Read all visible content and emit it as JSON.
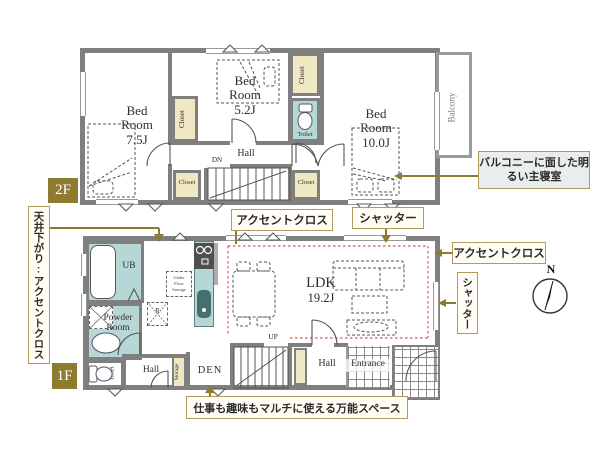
{
  "colors": {
    "wall": "#7f7f7f",
    "closet_fill": "#efe8c2",
    "water_fill": "#b7d6d6",
    "floor_badge": "#8d7b30",
    "annotation_border": "#b3995c",
    "leader_line": "#8d7b30",
    "accent_dotted": "#e07070"
  },
  "floor2": {
    "badge": "2F",
    "bedroom_75": {
      "l1": "Bed",
      "l2": "Room",
      "l3": "7.5J"
    },
    "bedroom_52": {
      "l1": "Bed",
      "l2": "Room",
      "l3": "5.2J"
    },
    "bedroom_100": {
      "l1": "Bed",
      "l2": "Room",
      "l3": "10.0J"
    },
    "hall": "Hall",
    "dn": "DN",
    "closet_left": "Closet",
    "closet_top": "Closet",
    "closet_stair_left": "Closet",
    "closet_stair_right": "Closet",
    "toilet": "Toilet",
    "balcony": "Balcony"
  },
  "floor1": {
    "badge": "1F",
    "ub": "UB",
    "powder": {
      "l1": "Powder",
      "l2": "Room"
    },
    "toilet": "Toilet",
    "hall_left": "Hall",
    "storage": "Storage",
    "den": "DEN",
    "up": "UP",
    "ldk": {
      "l1": "LDK",
      "l2": "19.2J"
    },
    "hall_right": "Hall",
    "entrance": "Entrance",
    "refrigerator": "R",
    "under_floor": {
      "l1": "Under",
      "l2": "Floor",
      "l3": "Storage"
    }
  },
  "annotations": {
    "ceiling_accent": "天井下がり:アクセントクロス",
    "accent_cloth_top": "アクセントクロス",
    "shutter_top": "シャッター",
    "accent_cloth_right": "アクセントクロス",
    "shutter_right": "シャッター",
    "master_bedroom": "バルコニーに面した明るい主寝室",
    "den_note": "仕事も趣味もマルチに使える万能スペース"
  },
  "compass": {
    "north": "N"
  }
}
